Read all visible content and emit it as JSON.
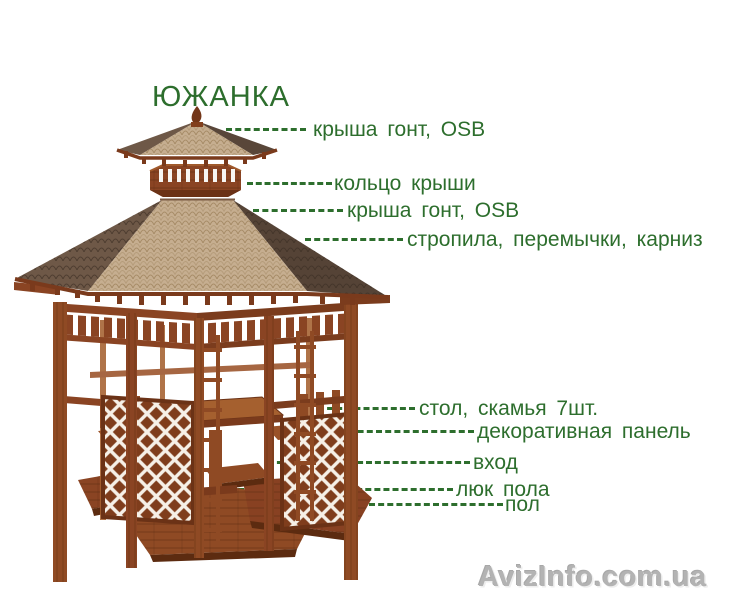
{
  "title": "ЮЖАНКА",
  "labels": {
    "cap_roof": "крыша гонт, OSB",
    "roof_ring": "кольцо крыши",
    "main_roof": "крыша гонт, OSB",
    "rafters": "стропила, перемычки, карниз",
    "table_benches": "стол, скамья 7шт.",
    "decor_panel": "декоративная панель",
    "entrance": "вход",
    "floor_hatch": "люк пола",
    "floor": "пол"
  },
  "watermark": "AvizInfo.com.ua",
  "colors": {
    "label_green": "#2d6e2d",
    "wood_brown": "#8a4423",
    "roof_tan": "#c6ae90",
    "roof_shadow_brown": "#5a4636",
    "watermark_gray": "#b3b3b3",
    "background": "#ffffff"
  }
}
